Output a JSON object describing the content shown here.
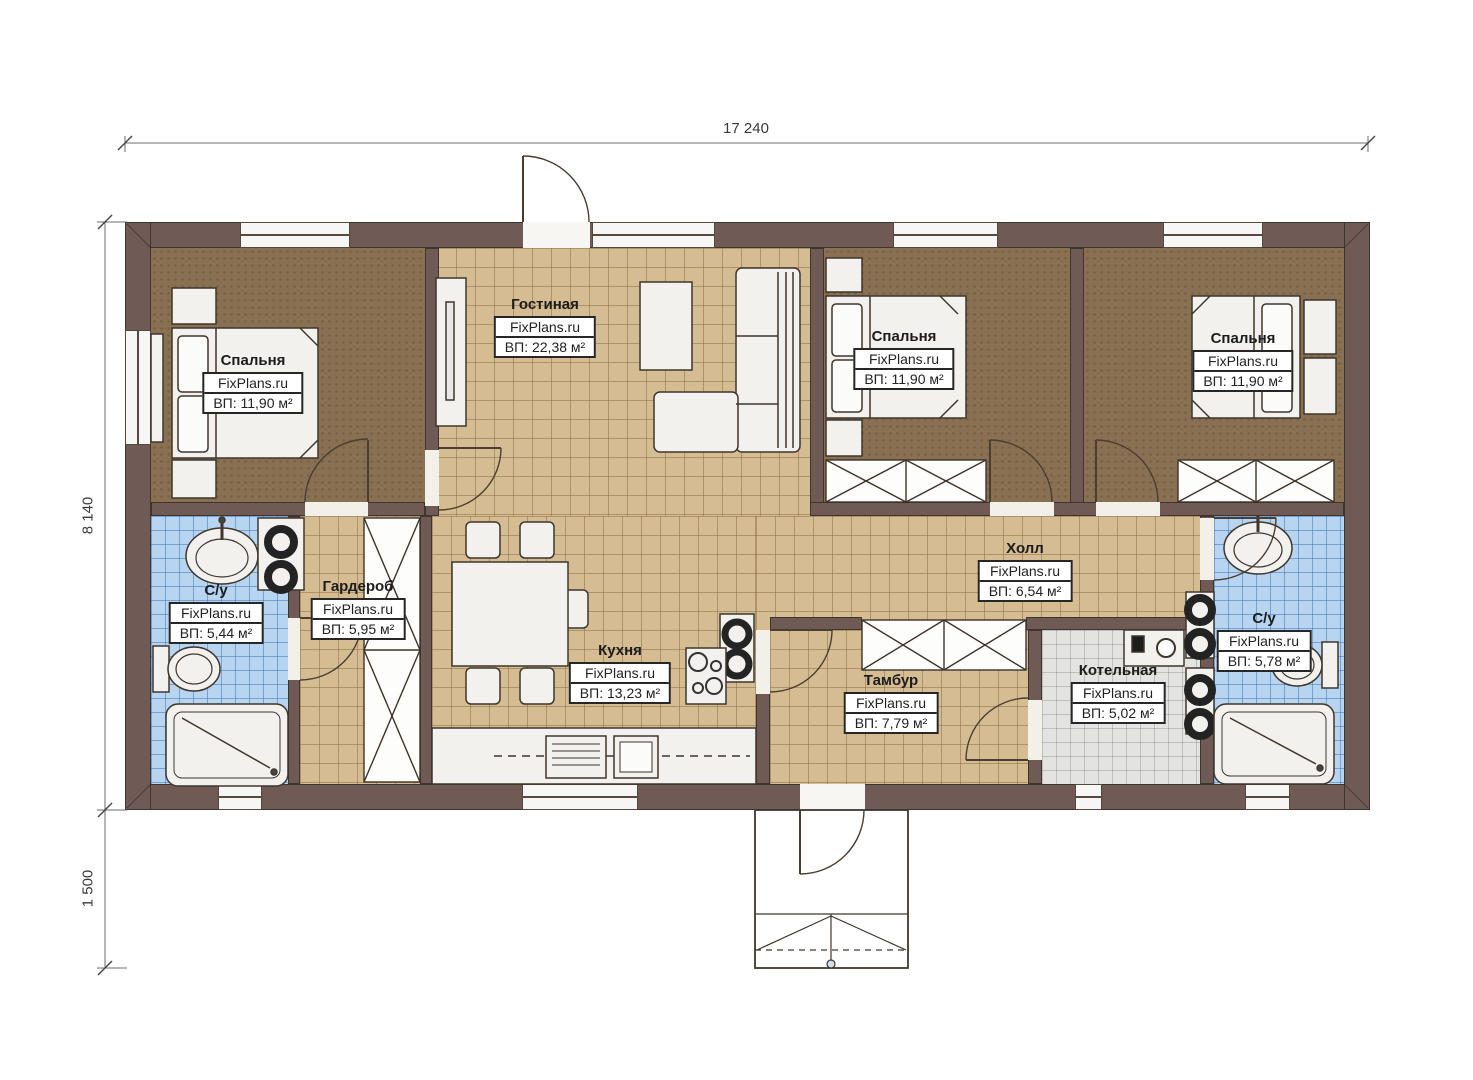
{
  "plan": {
    "watermark": "FixPlans.ru",
    "dimensions": {
      "total_width": "17 240",
      "total_height": "8 140",
      "porch_depth": "1 500"
    },
    "rooms": [
      {
        "id": "bedroom-left",
        "name": "Спальня",
        "area": "ВП: 11,90 м²"
      },
      {
        "id": "living-room",
        "name": "Гостиная",
        "area": "ВП: 22,38 м²"
      },
      {
        "id": "bedroom-middle",
        "name": "Спальня",
        "area": "ВП: 11,90 м²"
      },
      {
        "id": "bedroom-right",
        "name": "Спальня",
        "area": "ВП: 11,90 м²"
      },
      {
        "id": "bathroom-left",
        "name": "С/у",
        "area": "ВП: 5,44 м²"
      },
      {
        "id": "wardrobe",
        "name": "Гардероб",
        "area": "ВП: 5,95 м²"
      },
      {
        "id": "kitchen",
        "name": "Кухня",
        "area": "ВП: 13,23 м²"
      },
      {
        "id": "hall",
        "name": "Холл",
        "area": "ВП: 6,54 м²"
      },
      {
        "id": "vestibule",
        "name": "Тамбур",
        "area": "ВП: 7,79 м²"
      },
      {
        "id": "boiler-room",
        "name": "Котельная",
        "area": "ВП: 5,02 м²"
      },
      {
        "id": "bathroom-right",
        "name": "С/у",
        "area": "ВП: 5,78 м²"
      }
    ],
    "colors": {
      "wall": "#6f5a55",
      "floor_tile_tan": "#d6bc92",
      "floor_bedroom": "#8a7052",
      "floor_bathroom": "#b7d4f0",
      "floor_boiler": "#e3e3e2",
      "label_border": "#262626"
    }
  }
}
